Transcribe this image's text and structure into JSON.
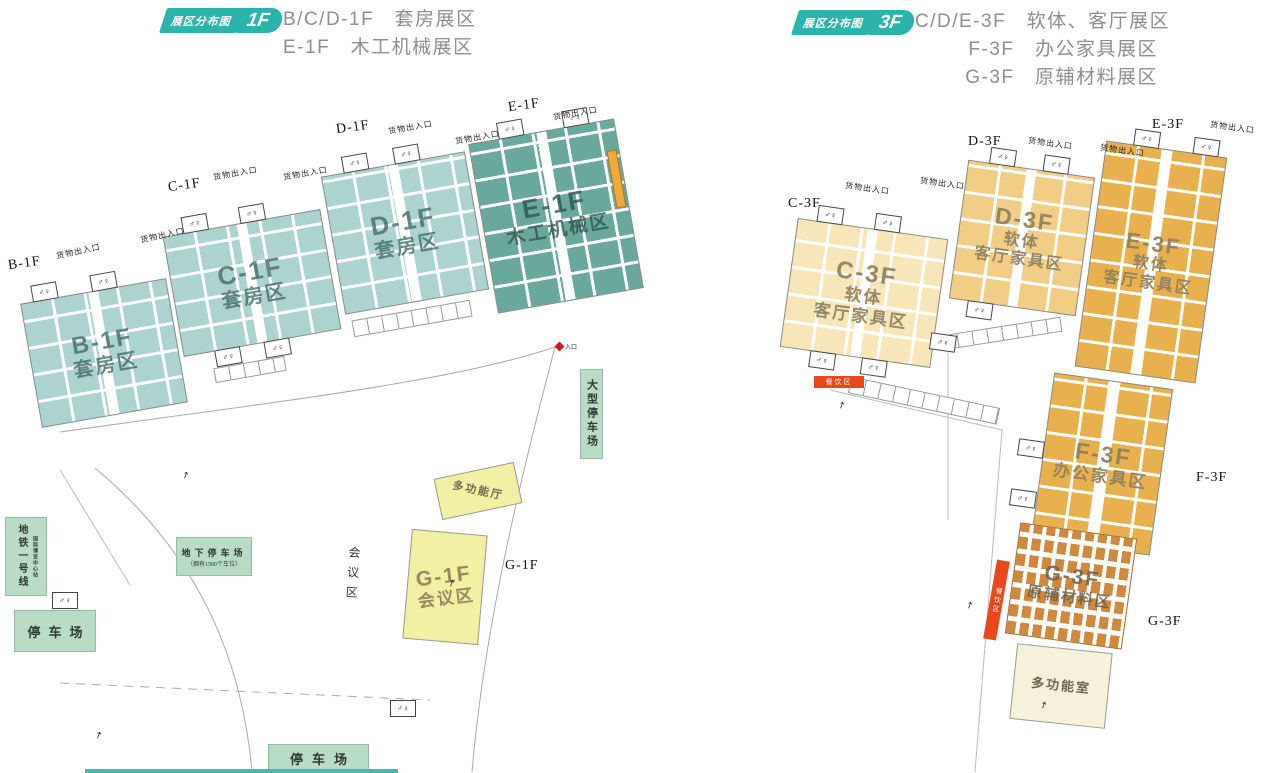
{
  "colors": {
    "accent_teal": "#2ab4ad",
    "hall_teal": "#abd4d1",
    "hall_teal_dark": "#68a89d",
    "hall_cream": "#f8e5b8",
    "hall_tan": "#f1cd86",
    "hall_amber": "#e9b14e",
    "booth_orange": "#d0893c",
    "hall_yellow": "#f3efa3",
    "green_box": "#b9dcc6",
    "red_bar": "#e8491b",
    "orange_strip": "#f2a93b"
  },
  "icons": {
    "restroom": "♂♀",
    "escalator": "↗"
  },
  "header_1f": {
    "badge_text": "展区分布图",
    "floor": "1F",
    "lines": [
      "B/C/D-1F　套房展区",
      "E-1F　木工机械展区"
    ]
  },
  "header_3f": {
    "badge_text": "展区分布图",
    "floor": "3F",
    "lines": [
      "C/D/E-3F　软体、客厅展区",
      "F-3F　办公家具展区",
      "G-3F　原辅材料展区"
    ]
  },
  "map_1f": {
    "cargo_label": "货物出入口",
    "halls": {
      "b": {
        "code": "B-1F",
        "name": "套房区",
        "outside": "B-1F"
      },
      "c": {
        "code": "C-1F",
        "name": "套房区",
        "outside": "C-1F"
      },
      "d": {
        "code": "D-1F",
        "name": "套房区",
        "outside": "D-1F"
      },
      "e": {
        "code": "E-1F",
        "name": "木工机械区",
        "outside": "E-1F"
      },
      "g": {
        "code": "G-1F",
        "name": "会议区",
        "outside": "G-1F"
      }
    },
    "multi_hall": "多功能厅",
    "meeting_vertical": "会议区",
    "entrance": "入口",
    "metro": {
      "line": "地铁一号线",
      "station": "国际博览中心站"
    },
    "parking_west": "停车场",
    "underground": {
      "title": "地下停车场",
      "sub": "（拥有1500个车位）"
    },
    "parking_large": "大型停车场",
    "parking_south": "停车场"
  },
  "map_3f": {
    "cargo_label": "货物出入口",
    "halls": {
      "c": {
        "code": "C-3F",
        "line1": "软体",
        "line2": "客厅家具区",
        "outside": "C-3F"
      },
      "d": {
        "code": "D-3F",
        "line1": "软体",
        "line2": "客厅家具区",
        "outside": "D-3F"
      },
      "e": {
        "code": "E-3F",
        "line1": "软体",
        "line2": "客厅家具区",
        "outside": "E-3F"
      },
      "f": {
        "code": "F-3F",
        "line1": "办公家具区",
        "outside": "F-3F"
      },
      "g": {
        "code": "G-3F",
        "line1": "原辅材料区",
        "outside": "G-3F"
      }
    },
    "dining": "餐饮区",
    "multi_room": "多功能室"
  }
}
